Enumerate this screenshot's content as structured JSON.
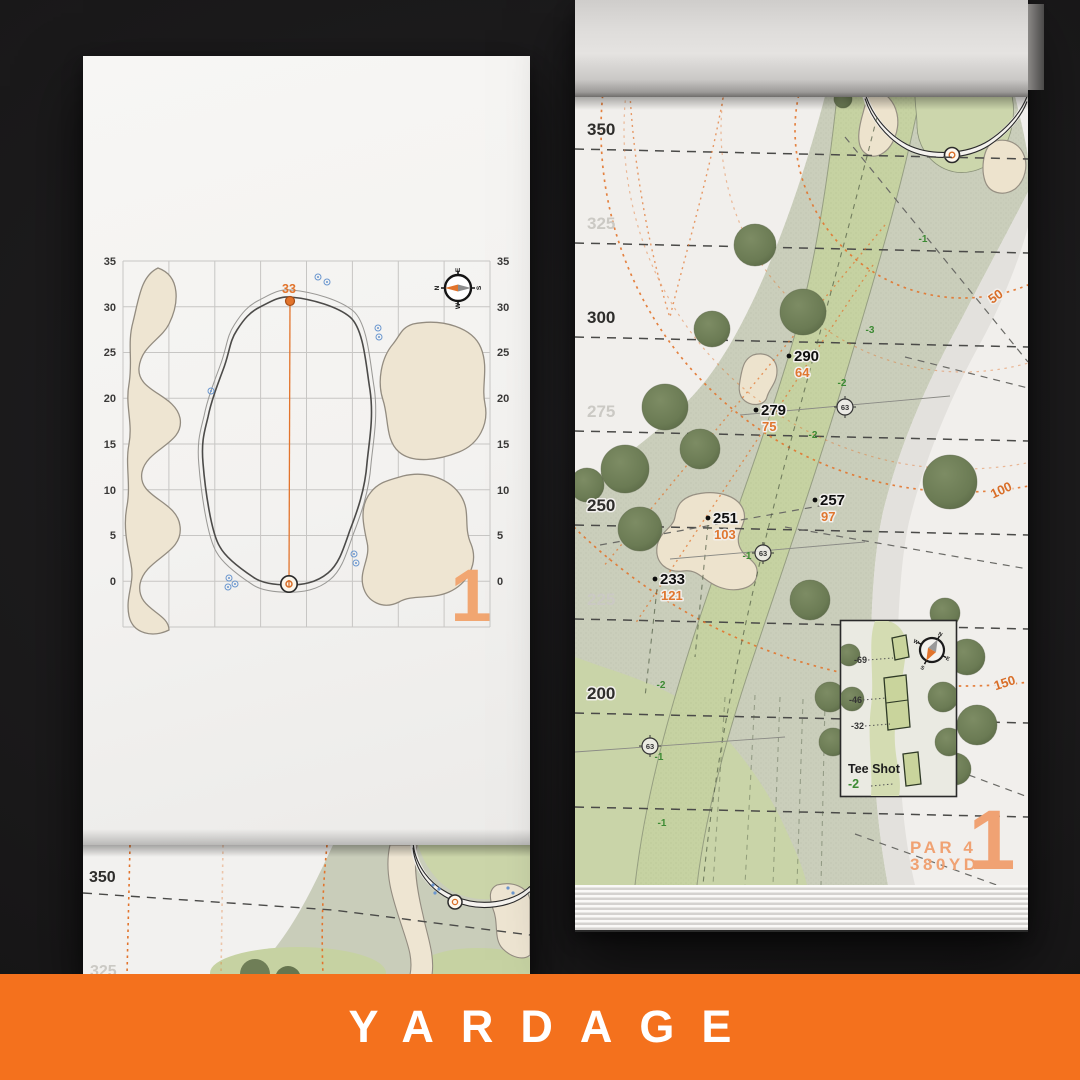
{
  "banner": {
    "title": "YARDAGE",
    "color": "#F4711D"
  },
  "palette": {
    "accent_orange": "#E2742C",
    "numeral_orange": "#F0A273",
    "elevation_green": "#3C8A33",
    "sprinkler_blue": "#5B8FD0"
  },
  "left_page": {
    "hole_number": "1",
    "pin_distance": "33",
    "axis_labels": [
      "35",
      "30",
      "25",
      "20",
      "15",
      "10",
      "5",
      "0"
    ],
    "compass": {
      "n": "N",
      "e": "E",
      "s": "S",
      "w": "W"
    }
  },
  "right_page": {
    "hole_number": "1",
    "par_label": "PAR 4",
    "yardage_label": "380YD",
    "scale_labels": [
      "350",
      "325",
      "300",
      "275",
      "250",
      "225",
      "200"
    ],
    "points": [
      {
        "carry": "290",
        "to_green": "64"
      },
      {
        "carry": "279",
        "to_green": "75"
      },
      {
        "carry": "257",
        "to_green": "97"
      },
      {
        "carry": "251",
        "to_green": "103"
      },
      {
        "carry": "233",
        "to_green": "121"
      }
    ],
    "arc_labels": [
      "50",
      "100",
      "150"
    ],
    "sprinkler_number": "63",
    "elevation_marks": [
      "-1",
      "-3",
      "-2",
      "-2",
      "-1",
      "-2",
      "-1",
      "-1"
    ],
    "tee_inset": {
      "title": "Tee Shot",
      "elevation": "-2",
      "tee_offsets": [
        "-69",
        "-46",
        "-32"
      ],
      "compass": {
        "n": "N",
        "e": "E",
        "s": "S",
        "w": "W"
      }
    }
  },
  "bottom_page": {
    "scale_labels": [
      "350",
      "325"
    ]
  }
}
